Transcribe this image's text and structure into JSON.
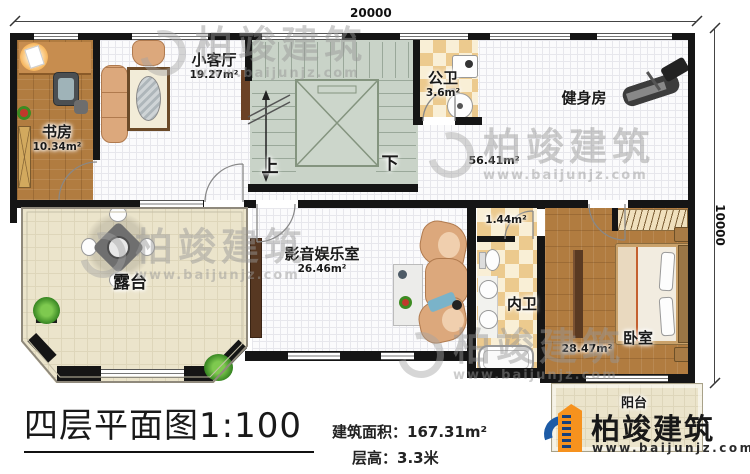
{
  "dimensions": {
    "width_mm": "20000",
    "depth_mm": "10000"
  },
  "rooms": {
    "study": {
      "name": "书房",
      "area": "10.34m²"
    },
    "small_living": {
      "name": "小客厅",
      "area": "19.27m²"
    },
    "public_bath": {
      "name": "公卫",
      "area": "3.6m²"
    },
    "gym": {
      "name": "健身房",
      "area": "56.41m²"
    },
    "media_room": {
      "name": "影音娱乐室",
      "area": "26.46m²"
    },
    "terrace": {
      "name": "露台"
    },
    "vestibule": {
      "area": "1.44m²"
    },
    "inner_bath": {
      "name": "内卫"
    },
    "bedroom": {
      "name": "卧室",
      "area": "28.47m²"
    },
    "balcony": {
      "name": "阳台"
    }
  },
  "stairs": {
    "up_label": "上",
    "down_label": "下"
  },
  "title_block": {
    "title": "四层平面图",
    "scale": "1:100",
    "area_label": "建筑面积：",
    "area_value": "167.31m²",
    "floor_height_label": "层高：",
    "floor_height_value": "3.3米"
  },
  "logo": {
    "company": "柏竣建筑",
    "website": "www.baijunjz.com"
  },
  "watermark": {
    "company": "柏竣建筑",
    "website": "www.baijunjz.com"
  },
  "colors": {
    "wall": "#151515",
    "wood_floor": "#b17c40",
    "terrace_floor": "#ebe4cb",
    "tile_checker": "#ecca8e",
    "stair_fill": "#c9d3c8",
    "sofa": "#dca87c",
    "logo_blue": "#1d5ba6",
    "logo_orange": "#f6921e"
  }
}
